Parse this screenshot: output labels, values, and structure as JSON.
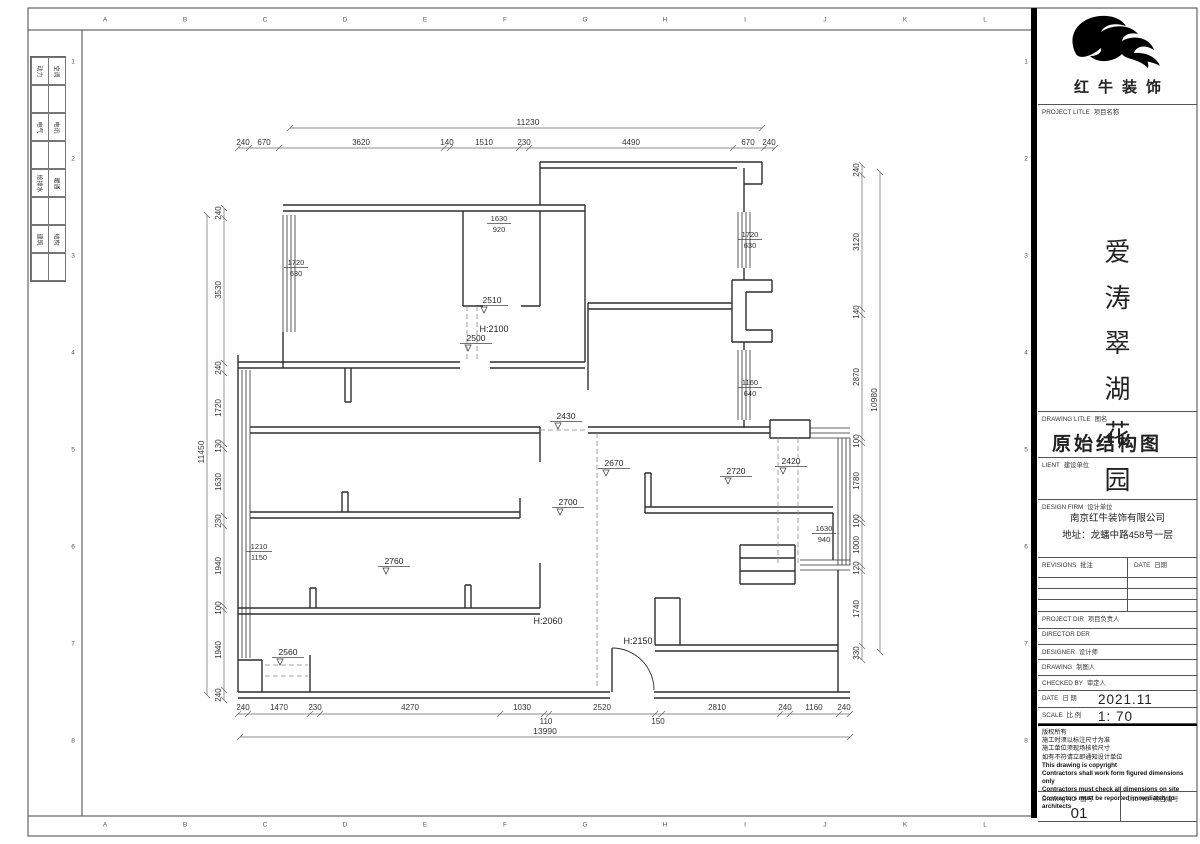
{
  "frame": {
    "letters": [
      "A",
      "B",
      "C",
      "D",
      "E",
      "F",
      "G",
      "H",
      "I",
      "J",
      "K",
      "L"
    ],
    "numbers": [
      "1",
      "2",
      "3",
      "4",
      "5",
      "6",
      "7",
      "8"
    ]
  },
  "disciplines": [
    {
      "a": "动力",
      "b": "空调"
    },
    {
      "a": "电气",
      "b": "电讯"
    },
    {
      "a": "给排水",
      "b": "暖通"
    },
    {
      "a": "建筑",
      "b": "结构"
    }
  ],
  "title_block": {
    "logo_text": "红牛装饰",
    "project_label_en": "PROJECT LITLE",
    "project_label_cn": "项目名称",
    "project_name": "爱涛翠湖花园",
    "drawing_label_en": "DRAWING LITLE",
    "drawing_label_cn": "图名",
    "drawing_title": "原始结构图",
    "client_label_en": "LIENT",
    "client_label_cn": "建设单位",
    "firm_label_en": "DESIGN FIRM",
    "firm_label_cn": "设计单位",
    "firm_name": "南京红牛装饰有限公司",
    "firm_address": "地址：龙蟠中路458号一层",
    "revisions_label_en": "REVISIONS",
    "revisions_label_cn": "批注",
    "revisions_date_en": "DATE",
    "revisions_date_cn": "日期",
    "rows": [
      {
        "en": "PROJECT DIR",
        "cn": "项目负责人",
        "value": ""
      },
      {
        "en": "DIRECTOR DER",
        "cn": "",
        "value": ""
      },
      {
        "en": "DESIGNER",
        "cn": "设计师",
        "value": ""
      },
      {
        "en": "DRAWING",
        "cn": "制图人",
        "value": ""
      },
      {
        "en": "CHECKED BY",
        "cn": "审定人",
        "value": ""
      },
      {
        "en": "DATE",
        "cn": "日 期",
        "value": "2021.11"
      },
      {
        "en": "SCALE",
        "cn": "比 例",
        "value": "1: 70"
      }
    ],
    "notes": [
      "版权所有",
      "施工时须以标注尺寸为准",
      "施工单位须现场核验尺寸",
      "如有不符请立即通知设计单位",
      "This drawing is copyright",
      "Contractors shall work form figured dimensions only",
      "Contractors must check all dimensions on site",
      "Contractors must be reported immediately to architects"
    ],
    "drawing_no_label_en": "Drawing NO",
    "drawing_no_label_cn": "图号",
    "drawing_no": "01",
    "job_no_label_en": "Job NO",
    "job_no_label_cn": "项目编号",
    "job_no": ""
  },
  "plan": {
    "dim_top": [
      "240",
      "670",
      "3620",
      "140",
      "1510",
      "230",
      "4490",
      "670",
      "240"
    ],
    "dim_top_total": "11230",
    "dim_bottom": [
      "240",
      "1470",
      "230",
      "4270",
      "1030",
      "2520",
      "2810",
      "240",
      "1160",
      "240"
    ],
    "dim_bottom_sub": [
      "110",
      "150"
    ],
    "dim_bottom_total": "13990",
    "dim_left": [
      "240",
      "3530",
      "240",
      "1720",
      "130",
      "1630",
      "230",
      "1940",
      "100",
      "1940",
      "240"
    ],
    "dim_left_total": "11450",
    "dim_right": [
      "240",
      "3120",
      "140",
      "2870",
      "100",
      "1780",
      "100",
      "1000",
      "120",
      "1740",
      "330"
    ],
    "dim_right_total": "10980",
    "levels": [
      "2510",
      "2500",
      "2430",
      "2670",
      "2700",
      "2720",
      "2420",
      "2760",
      "2560"
    ],
    "heights": [
      "H:2100",
      "H:2060",
      "H:2150"
    ],
    "windows": [
      {
        "w": "1720",
        "s": "630"
      },
      {
        "w": "1630",
        "s": "920"
      },
      {
        "w": "1720",
        "s": "630"
      },
      {
        "w": "1160",
        "s": "640"
      },
      {
        "w": "1630",
        "s": "940"
      },
      {
        "w": "1210",
        "s": "1150"
      }
    ]
  }
}
